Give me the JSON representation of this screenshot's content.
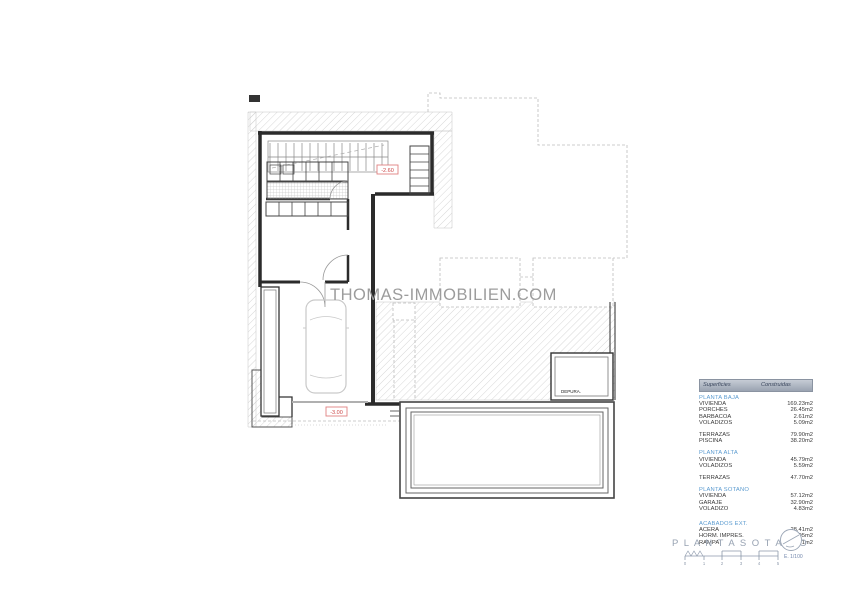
{
  "watermark": "THOMAS-IMMOBILIEN.COM",
  "plan": {
    "upper_elevation_label": "-2.60",
    "lower_elevation_label": "-3.00",
    "depura_label": "DEPURA.",
    "title": "P L A N T A   S O T A N O",
    "scale_text": "E. 1/100",
    "scale_numbers": [
      "0",
      "1",
      "2",
      "3",
      "4",
      "5"
    ]
  },
  "areas_table": {
    "header": {
      "col1": "Superficies",
      "col2": "Construidas"
    },
    "groups": [
      {
        "title": "PLANTA BAJA",
        "rows": [
          {
            "label": "VIVIENDA",
            "value": "169.23m2"
          },
          {
            "label": "PORCHES",
            "value": "26.45m2"
          },
          {
            "label": "BARBACOA",
            "value": "2.61m2"
          },
          {
            "label": "VOLADIZOS",
            "value": "5.09m2"
          }
        ]
      },
      {
        "title": "",
        "rows": [
          {
            "label": "TERRAZAS",
            "value": "79.90m2"
          },
          {
            "label": "PISCINA",
            "value": "38.20m2"
          }
        ]
      },
      {
        "title": "PLANTA ALTA",
        "rows": [
          {
            "label": "VIVIENDA",
            "value": "45.79m2"
          },
          {
            "label": "VOLADIZOS",
            "value": "5.59m2"
          }
        ]
      },
      {
        "title": "",
        "rows": [
          {
            "label": "TERRAZAS",
            "value": "47.70m2"
          }
        ]
      },
      {
        "title": "PLANTA SOTANO",
        "rows": [
          {
            "label": "VIVIENDA",
            "value": "57.12m2"
          },
          {
            "label": "GARAJE",
            "value": "32.90m2"
          },
          {
            "label": "VOLADIZO",
            "value": "4.83m2"
          }
        ]
      },
      {
        "title": "ACABADOS EXT.",
        "rows": [
          {
            "label": "ACERA",
            "value": "28.41m2"
          },
          {
            "label": "HORM. IMPRES.",
            "value": "66.95m2"
          },
          {
            "label": "RAMPA",
            "value": "158.71m2"
          }
        ]
      }
    ]
  },
  "colors": {
    "wall": "#2b2b2b",
    "hatch": "#cdcdcd",
    "dashed": "#bdbdbd",
    "red_label": "#cc4444",
    "section_title": "#5b9bd0",
    "titleblock": "#8d99ab",
    "scale_text": "#7287ac",
    "watermark": "#9c9c9c"
  }
}
